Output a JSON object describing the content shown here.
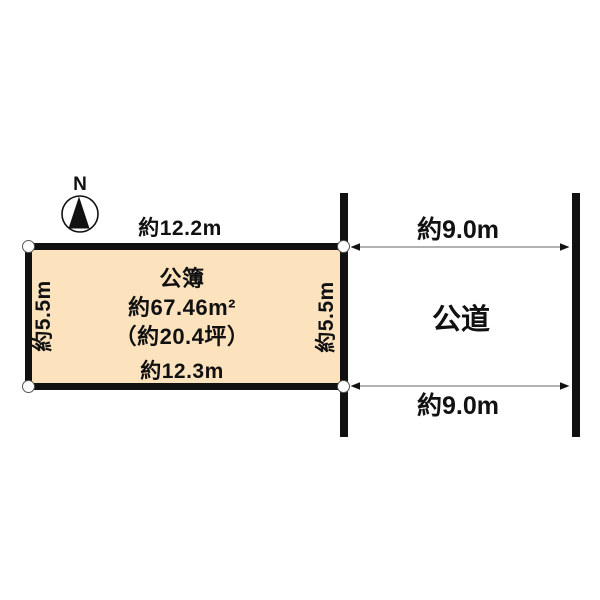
{
  "compass": {
    "label": "N"
  },
  "plot": {
    "registry_label": "公簿",
    "area_sqm": "約67.46m²",
    "area_tsubo": "（約20.4坪）",
    "top_edge": "約12.2m",
    "bottom_edge": "約12.3m",
    "left_edge": "約5.5m",
    "right_edge": "約5.5m"
  },
  "road": {
    "label": "公道",
    "top_width": "約9.0m",
    "bottom_width": "約9.0m"
  },
  "colors": {
    "plot_fill": "#FCE3BE",
    "line_black": "#111111",
    "arrow_gray": "#999999",
    "marker_stroke": "#555555"
  }
}
